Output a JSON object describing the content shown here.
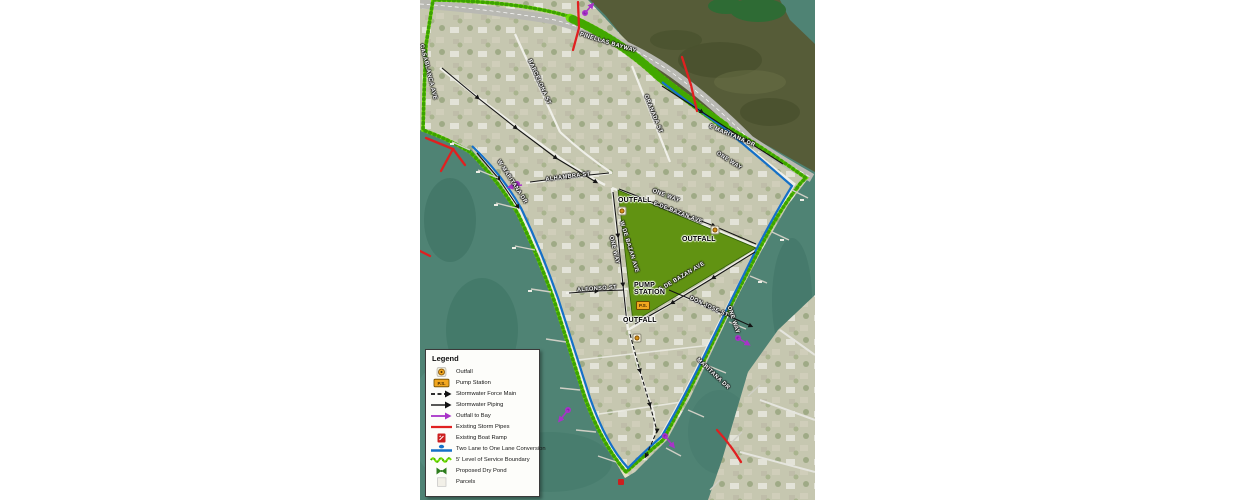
{
  "map": {
    "streets": {
      "pinellas_bayway": "PINELLAS BAYWAY",
      "e_maritana_dr": "E MARITANA DR",
      "w_maritana_dr": "W MARITANA DR",
      "maritana_dr_se": "MARITANA DR",
      "granada_st": "GRANADA ST",
      "barcelona_st": "BARCELONA ST",
      "casablanca_ave": "CASABLANCA AVE",
      "alhambra_st": "ALHAMBRA ST",
      "e_de_bazan_ave": "E DE BAZAN AVE",
      "w_de_bazan_ave": "W DE BAZAN AVE",
      "s_de_bazan_ave": "S DE BAZAN AVE",
      "alfonso_st": "ALFONSO ST",
      "don_jose_st": "DON JOSE ST",
      "one_way": "ONE WAY"
    },
    "features": {
      "outfall": "OUTFALL",
      "pump_station": "PUMP STATION",
      "pump_station_abbr": "P.S."
    }
  },
  "legend": {
    "title": "Legend",
    "items": [
      {
        "icon": "outfall-icon",
        "label": "Outfall"
      },
      {
        "icon": "pump-station-icon",
        "label": "Pump Station"
      },
      {
        "icon": "force-main-icon",
        "label": "Stormwater Force Main"
      },
      {
        "icon": "piping-icon",
        "label": "Stormwater Piping"
      },
      {
        "icon": "outfall-to-bay-icon",
        "label": "Outfall to Bay"
      },
      {
        "icon": "storm-pipes-icon",
        "label": "Existing Storm Pipes"
      },
      {
        "icon": "boat-ramp-icon",
        "label": "Existing Boat Ramp"
      },
      {
        "icon": "lane-conversion-icon",
        "label": "Two Lane to One Lane Conversion"
      },
      {
        "icon": "los-boundary-icon",
        "label": "5' Level of Service Boundary"
      },
      {
        "icon": "dry-pond-icon",
        "label": "Proposed Dry Pond"
      },
      {
        "icon": "parcels-icon",
        "label": "Parcels"
      }
    ]
  },
  "colors": {
    "los_boundary_green": "#70e000",
    "lane_conversion_blue": "#1470c8",
    "dry_pond_green": "#619312",
    "storm_pipe_red": "#e02020",
    "outfall_to_bay_purple": "#a833c8",
    "outfall_orange": "#f2a71f",
    "water_teal": "#4f8374",
    "bay_olive": "#565c38"
  }
}
